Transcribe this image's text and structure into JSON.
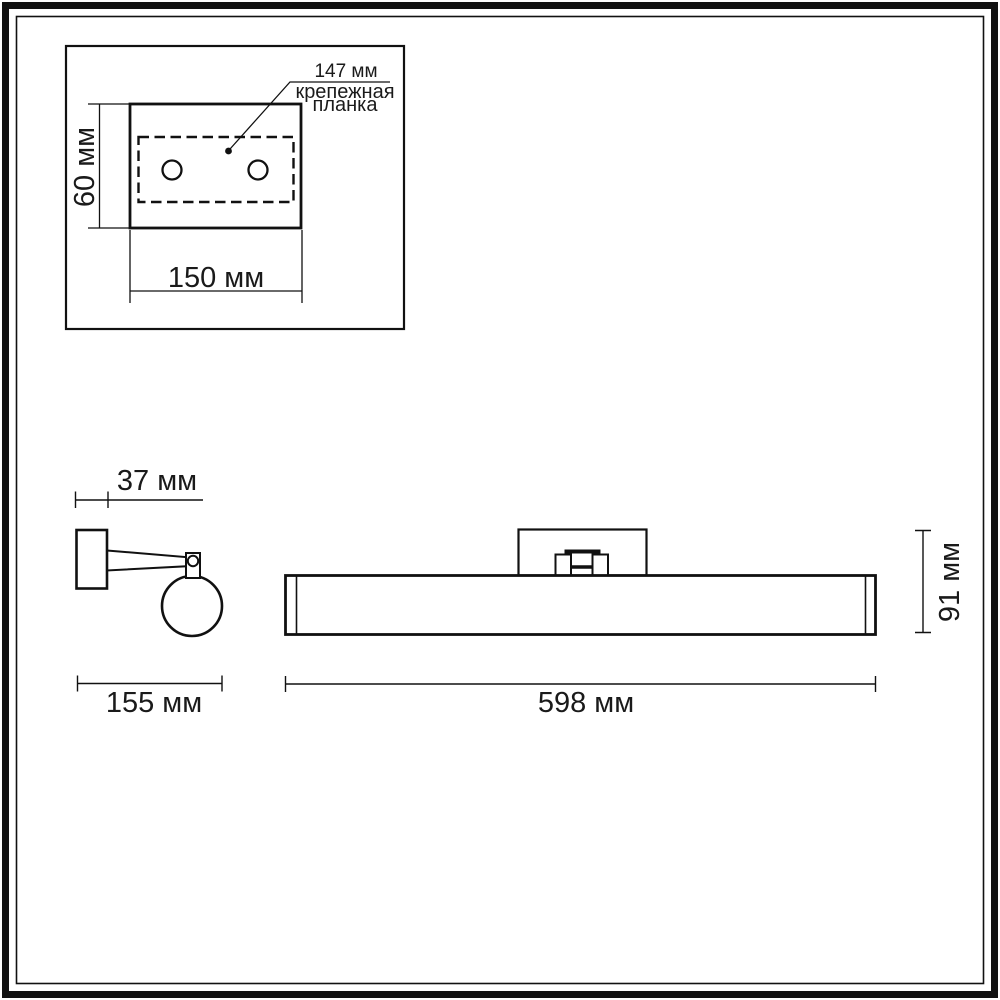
{
  "drawing": {
    "kind": "wall-lamp dimensional drawing",
    "units": "мм",
    "colors": {
      "line": "#111111",
      "background": "#ffffff"
    },
    "inset": {
      "hole_pitch_label": "147 мм",
      "plate_name_line1": "крепежная",
      "plate_name_line2": "планка",
      "plate_height_label": "60 мм",
      "plate_width_label": "150 мм"
    },
    "side_view": {
      "wall_bracket_depth_label": "37 мм",
      "overall_depth_label": "155 мм"
    },
    "front_view": {
      "overall_height_label": "91 мм",
      "overall_width_label": "598 мм"
    }
  }
}
